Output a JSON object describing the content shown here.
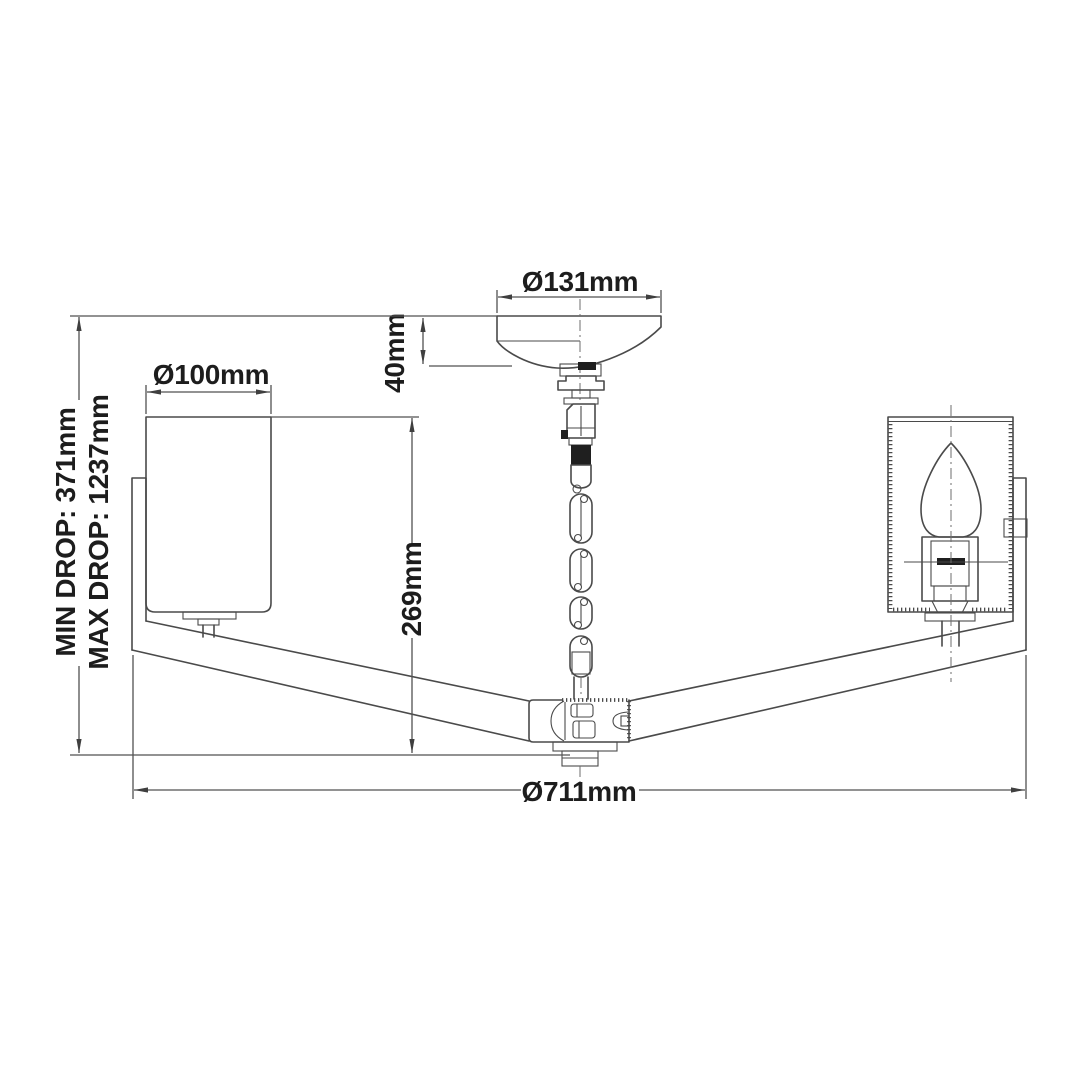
{
  "diagram": {
    "title": "ceiling-light-dimension-drawing",
    "labels": {
      "canopy_diameter": "Ø131mm",
      "canopy_height": "40mm",
      "shade_diameter": "Ø100mm",
      "stem_length": "269mm",
      "min_drop": "MIN DROP: 371mm",
      "max_drop": "MAX DROP: 1237mm",
      "fixture_diameter": "Ø711mm"
    },
    "colors": {
      "background": "#ffffff",
      "line": "#4a4a4a",
      "dim_line": "#525252",
      "text": "#1d1d1d"
    }
  }
}
